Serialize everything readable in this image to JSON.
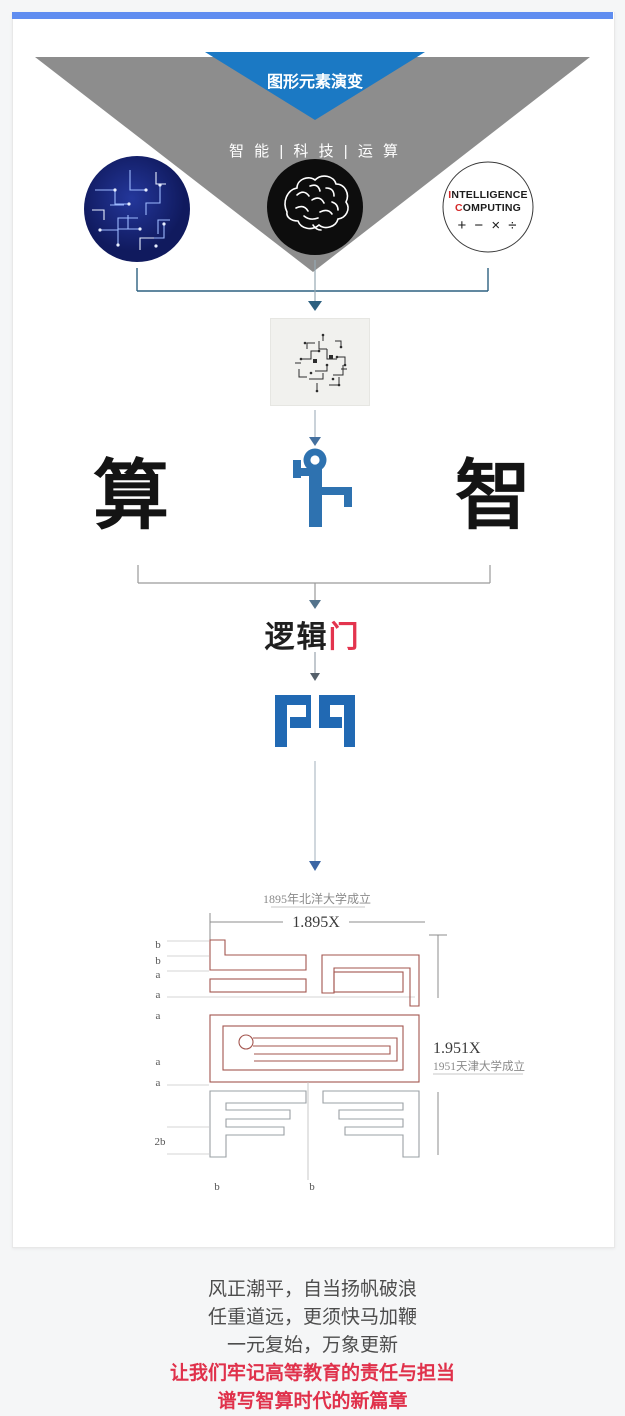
{
  "banner": {
    "title": "图形元素演变",
    "subtitle": "智 能 | 科 技 | 运 算"
  },
  "sources": {
    "computing_circle": {
      "line1_initial": "I",
      "line1_rest": "NTELLIGENCE",
      "line2_initial": "C",
      "line2_rest": "OMPUTING",
      "symbols": "+  −  ×  ÷"
    }
  },
  "concepts": {
    "left": "算",
    "right": "智"
  },
  "logic_gate": {
    "black_part": "逻辑",
    "red_part": "门"
  },
  "blueprint": {
    "top_caption": "1895年北洋大学成立",
    "top_dimension": "1.895X",
    "right_dimension": "1.951X",
    "right_caption": "1951天津大学成立",
    "labels_left": [
      "b",
      "b",
      "a",
      "a",
      "a",
      "a",
      "a",
      "2b"
    ],
    "labels_bottom": [
      "b",
      "b"
    ]
  },
  "footer": {
    "line1": "风正潮平，自当扬帆破浪",
    "line2": "任重道远，更须快马加鞭",
    "line3": "一元复始，万象更新",
    "line4": "让我们牢记高等教育的责任与担当",
    "line5": "谱写智算时代的新篇章"
  },
  "colors": {
    "banner_blue": "#1b79c4",
    "banner_gray": "#8d8d8d",
    "accent_strip": "#5f8df0",
    "logo_blue": "#2169b3",
    "figure_blue": "#2e72b0",
    "highlight_red": "#e0314b",
    "blueprint_outline_red": "#a3554e",
    "blueprint_outline_gray": "#9aa0a4"
  }
}
